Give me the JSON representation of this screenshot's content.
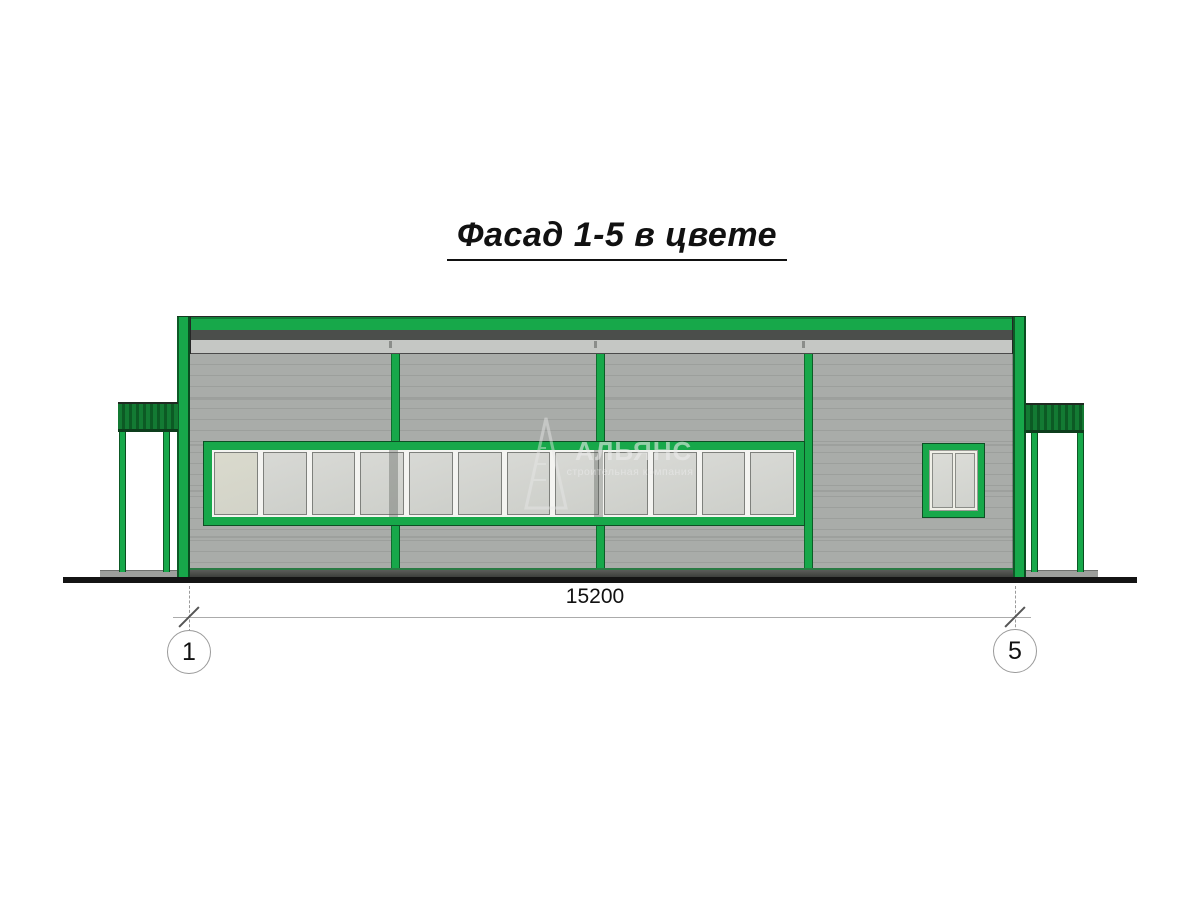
{
  "title": {
    "text": "Фасад 1-5 в цвете"
  },
  "watermark": {
    "name": "АЛЬЯНС",
    "tagline": "строительная компания",
    "logo": "pyramid-logo"
  },
  "dimension": {
    "value": "15200"
  },
  "axes": {
    "left": "1",
    "right": "5"
  },
  "facade": {
    "window_strip": {
      "pane_count": 12
    },
    "small_window": {
      "pane_count": 2
    },
    "colors": {
      "frame_green": "#17a84a",
      "canopy_green": "#137a33",
      "wall_gray": "#a9aca9",
      "parapet_dark_stripe": "#4b4e4b",
      "parapet_light": "#c5c7c4",
      "window_white": "#f4f4f1",
      "ground_black": "#141414"
    }
  }
}
